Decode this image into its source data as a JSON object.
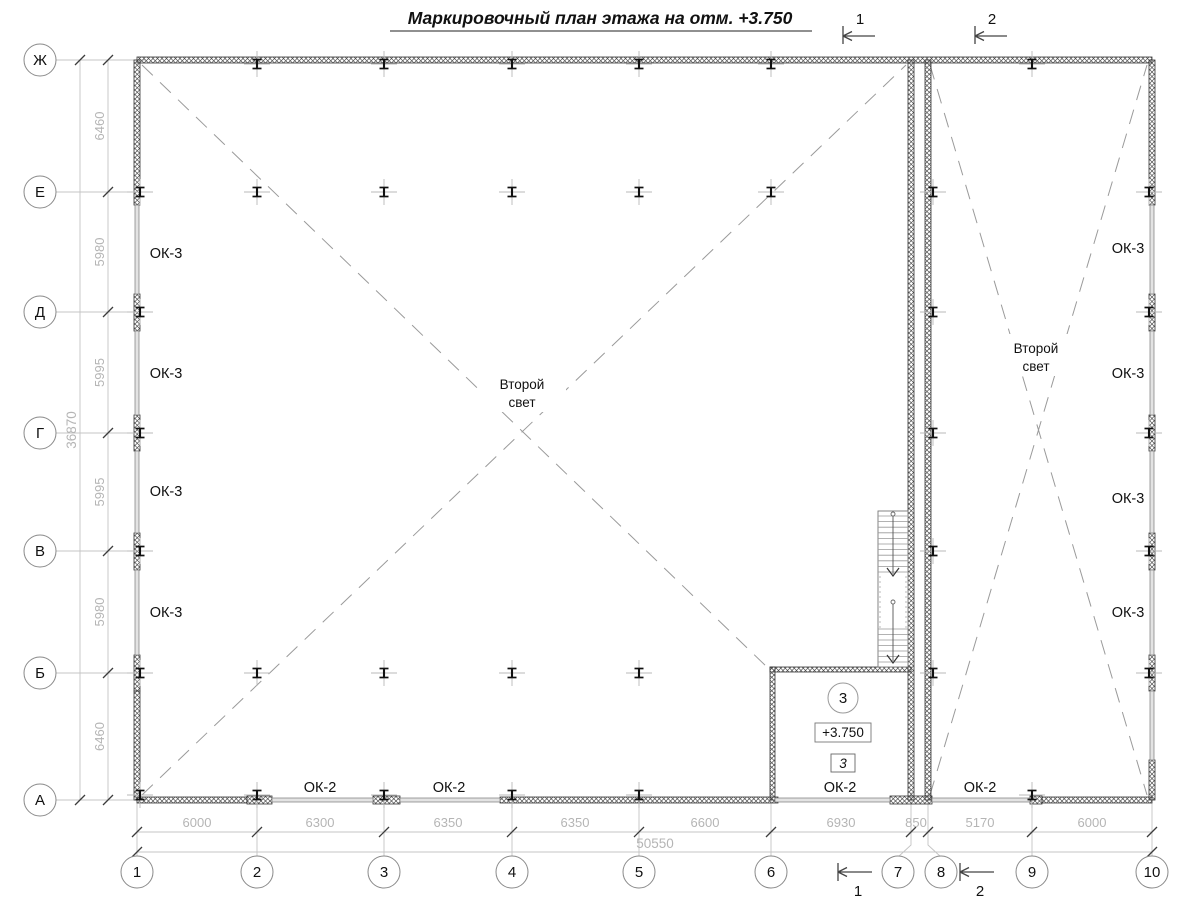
{
  "title": "Маркировочный план этажа на отм. +3.750",
  "axes": {
    "rows": [
      "Ж",
      "Е",
      "Д",
      "Г",
      "В",
      "Б",
      "А"
    ],
    "cols": [
      "1",
      "2",
      "3",
      "4",
      "5",
      "6",
      "7",
      "8",
      "9",
      "10"
    ]
  },
  "dims": {
    "left": {
      "bays": [
        "6460",
        "5980",
        "5995",
        "5995",
        "5980",
        "6460"
      ],
      "total": "36870"
    },
    "bottom": {
      "bays": [
        "6000",
        "6300",
        "6350",
        "6350",
        "6600",
        "6930",
        "850",
        "5170",
        "6000"
      ],
      "total": "50550"
    }
  },
  "labels": {
    "ok3": "ОК-3",
    "ok2": "ОК-2",
    "second_light_line1": "Второй",
    "second_light_line2": "свет"
  },
  "room3": {
    "number": "3",
    "level": "+3.750",
    "mark": "3"
  },
  "sections": {
    "one": "1",
    "two": "2"
  }
}
